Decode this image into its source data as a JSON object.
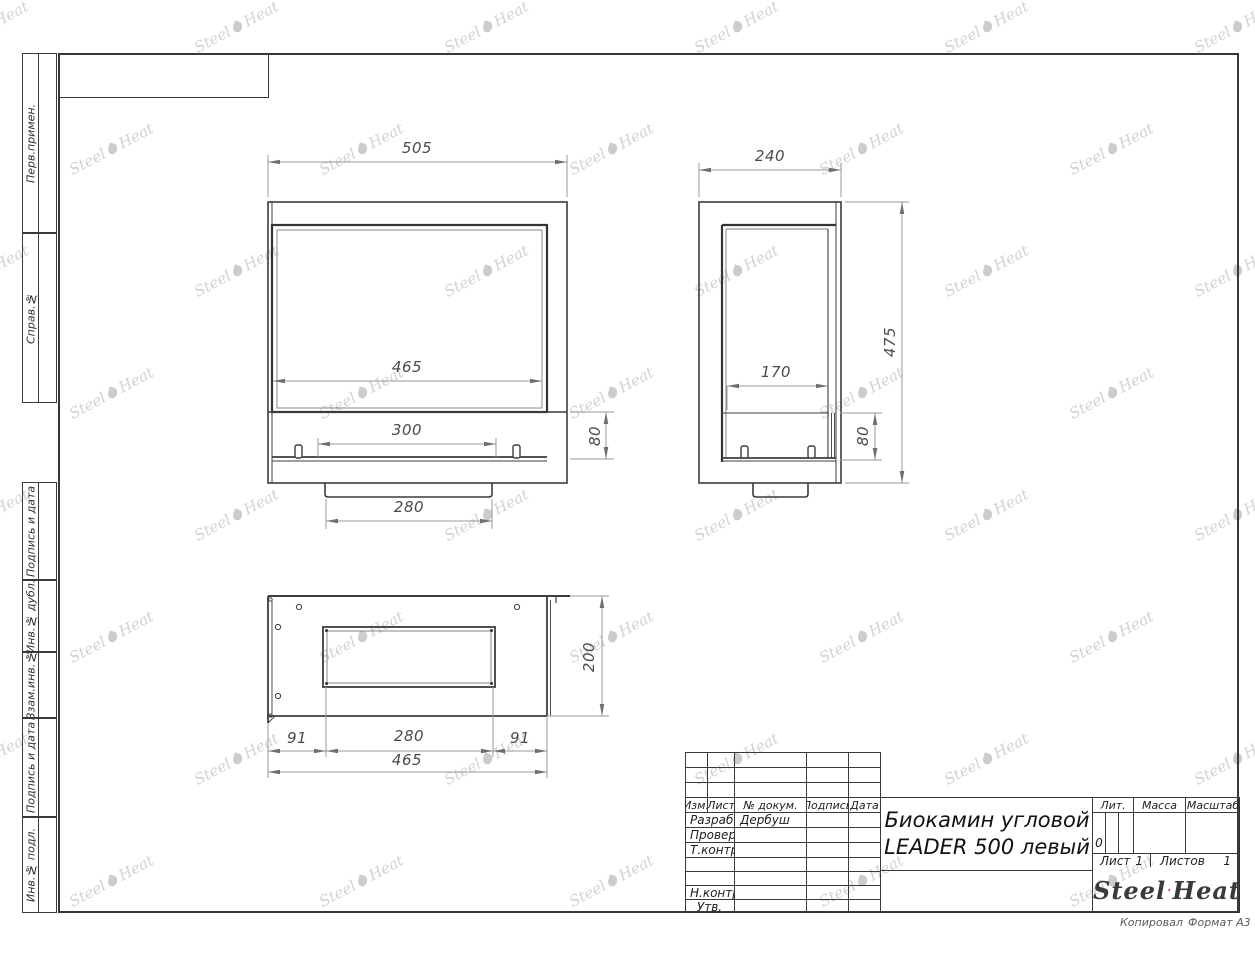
{
  "margin": {
    "items": [
      {
        "label": "Перв.примен."
      },
      {
        "label": "Справ.№"
      },
      {
        "label": "Подпись и дата"
      },
      {
        "label": "Инв.№ дубл."
      },
      {
        "label": "Взам.инв.№"
      },
      {
        "label": "Подпись и дата"
      },
      {
        "label": "Инв.№ подл."
      }
    ]
  },
  "views": {
    "front": {
      "dim_overall_width": "505",
      "dim_glass_width": "465",
      "dim_burner_slot": "300",
      "dim_tray_height": "80",
      "dim_base_width": "280"
    },
    "side": {
      "dim_depth": "240",
      "dim_overall_height": "475",
      "dim_tray_depth": "170",
      "dim_tray_height": "80"
    },
    "plan": {
      "dim_depth": "200",
      "dim_left_offset": "91",
      "dim_opening_width": "280",
      "dim_right_offset": "91",
      "dim_overall_width": "465"
    }
  },
  "title_block": {
    "columns": {
      "izm": "Изм.",
      "list": "Лист",
      "doc": "№ докум.",
      "sign": "Подпись",
      "date": "Дата"
    },
    "rows": [
      {
        "label": "Разраб.",
        "value": "Дербуш"
      },
      {
        "label": "Провер.",
        "value": ""
      },
      {
        "label": "Т.контр.",
        "value": ""
      },
      {
        "label": "",
        "value": ""
      },
      {
        "label": "",
        "value": ""
      },
      {
        "label": "Н.контр.",
        "value": ""
      },
      {
        "label": "Утв.",
        "value": ""
      }
    ],
    "title_line1": "Биокамин угловой",
    "title_line2": "LEADER 500 левый",
    "lit": {
      "label": "Лит.",
      "value": "0"
    },
    "mass_label": "Масса",
    "scale_label": "Масштаб",
    "sheet": {
      "label": "Лист",
      "value": "1"
    },
    "sheets": {
      "label": "Листов",
      "value": "1"
    },
    "logo": {
      "word1": "Steel",
      "word2": "Heat"
    }
  },
  "footer": {
    "copied": "Копировал",
    "format": "Формат А3"
  },
  "watermark": {
    "word1": "Steel",
    "word2": "Heat"
  },
  "colors": {
    "line": "#3c3c3c",
    "dim": "#8a8a8a",
    "dim_text": "#4a4a4a",
    "flame_red": "#e2231a",
    "flame_dark": "#9b1208"
  }
}
